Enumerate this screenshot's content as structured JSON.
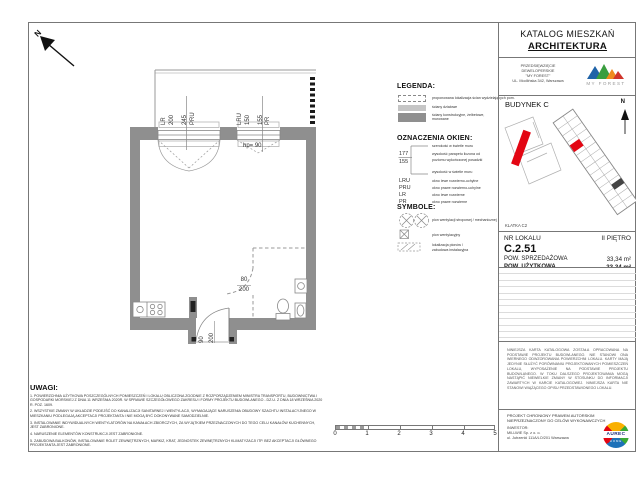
{
  "north_label": "N",
  "colors": {
    "accent_red": "#e30613",
    "wall_gray": "#8f8f8f"
  },
  "plan": {
    "window1": {
      "c1": "LR",
      "c2": "200",
      "c3": "245",
      "c4": "PRU"
    },
    "window2": {
      "c1": "LRU",
      "c2": "150",
      "c3": "155",
      "c4": "PR"
    },
    "hp_label": "hp= 90",
    "proposed_door_dim": {
      "top": "80",
      "bottom": "200"
    },
    "entry_door_dim": {
      "top": "90",
      "bottom": "200"
    }
  },
  "legend": {
    "title": "LEGENDA:",
    "items": [
      {
        "label": "proponowana lokalizacja ścian wydzielających pom."
      },
      {
        "label": "ściany działowe"
      },
      {
        "label": "ściany konstrukcyjne, żelbetowe,",
        "label2": "murowane"
      }
    ]
  },
  "windows_key": {
    "title": "OZNACZENIA OKIEN:",
    "width_label": "szerokość w świetle muru",
    "num_top": "177",
    "num_bottom": "155",
    "mid_label_1": "wysokość parapetu liczona od",
    "mid_label_2": "poziomu wykończonej posadzki",
    "height_label": "wysokość w świetle muru",
    "abbrevs": [
      {
        "abbr": "LRU",
        "label": "okno lewe rozwierno-uchylne"
      },
      {
        "abbr": "PRU",
        "label": "okno prawe rozwierno-uchylne"
      },
      {
        "abbr": "LR",
        "label": "okno lewe rozwierne"
      },
      {
        "abbr": "PR",
        "label": "okno prawe rozwierne"
      }
    ]
  },
  "symbols": {
    "title": "SYMBOLE:",
    "items": [
      {
        "label": "pion wentylacji stropowej / mechanicznej"
      },
      {
        "label": "pion wentylacyjny"
      },
      {
        "label": "lokalizacja pionów /",
        "label2": "zabudowa instalacyjna"
      }
    ]
  },
  "uwagi": {
    "title": "UWAGI:",
    "notes": [
      "1. POWIERZCHNIA UŻYTKOWA POSZCZEGÓLNYCH POMIESZCZEŃ I LOKALU OBLICZONA ZGODNIE Z ROZPORZĄDZENIEM MINISTRA TRANSPORTU, BUDOWNICTWA I GOSPODARKI MORSKIEJ Z DNIA 11 WRZEŚNIA 2020R. W SPRAWIE SZCZEGÓŁOWEGO ZAKRESU I FORMY PROJEKTU BUDOWLANEGO - DZ.U. Z DNIA 18 WRZEŚNIA 2020 R. POZ. 1609.",
      "2. WSZYSTKIE ZMIANY W UKŁADZIE PODEJŚĆ DO KANALIZACJI SANITARNEJ I WENTYLACJI, WYMAGAJĄCE NARUSZENIA OBUDOWY SZACHTU INSTALACYJNEGO W MIESZKANIU PODLEGAJĄ AKCEPTACJI PROJEKTANTA I NIE MOGĄ BYĆ DOKONYWANE SAMODZIELNIE.",
      "3. INSTALOWANIE INDYWIDUALNYCH WENTYLATORÓW NA KANAŁACH ZBIORCZYCH, ZA WYJĄTKIEM PRZEZNACZONYCH DO TEGO CELU KANAŁÓW KUCHENNYCH, JEST ZABRONIONE.",
      "4. NARUSZENIE ELEMENTÓW KONSTRUKCJI JEST ZABRONIONE.",
      "5. ZABUDOWA BALKONÓW, INSTALOWANIE ROLET ZEWNĘTRZNYCH, MARKIZ, KRAT, JEDNOSTEK ZEWNĘTRZNYCH KLIMATYZACJI ITP. BEZ AKCEPTACJI GŁÓWNEGO PROJEKTANTA JEST ZABRONIONE."
    ]
  },
  "scale": {
    "labels": [
      "0",
      "1",
      "2",
      "3",
      "4",
      "5"
    ]
  },
  "panel": {
    "catalog_title": "KATALOG MIESZKAŃ",
    "catalog_subtitle": "ARCHITEKTURA",
    "developer_lines": [
      "PRZEDSIĘWZIĘCIE",
      "DEWELOPERSKIE",
      "\"MY FOREST\"",
      "UL. Modlińska 342, Warszawa"
    ],
    "brand": "MY FOREST",
    "building_label": "BUDYNEK C",
    "building_north": "N",
    "klatka_label": "KLATKA C2",
    "unit": {
      "nr_label": "NR LOKALU",
      "floor": "II PIĘTRO",
      "number": "C.2.51",
      "rows": [
        {
          "label": "POW. SPRZEDAŻOWA",
          "value": "33,34 m²"
        },
        {
          "label": "POW. UŻYTKOWA",
          "value": "33,34 m²"
        }
      ],
      "empty_row_count": 12,
      "balkon_label": "BALKON",
      "balkon_value": "8,48 m²"
    },
    "disclaimer": "NINIEJSZA KARTA KATALOGOWA ZOSTAŁA OPRACOWANA NA PODSTAWIE PROJEKTU BUDOWLANEGO. NIE STANOWI ONA WIERNEGO ODWZOROWANIA POWIERZCHNI LOKALU. KARTY MAJĄ JEDYNIE SŁUŻYĆ PORÓWNANIU PROJEKTOWANYCH POMIESZCZEŃ LOKALU, WYPOSAŻENIE NA PODSTAWIE PROJEKTU BUDOWLANEGO. W TOKU DALSZEGO PROJEKTOWANIA MOGĄ NASTĄPIĆ NIEWIELKIE ZMIANY W STOSUNKU DO INFORMACJI ZAWARTYCH W KARCIE KATALOGOWEJ. NINIEJSZA KARTA NIE STANOWI WIĄŻĄCEGO OPISU PRZEDSTAWIONEGO LOKALU.",
    "copyright_1": "PROJEKT CHRONIONY PRAWEM AUTORSKIM",
    "copyright_2": "NIEPRZEZNACZONY DO CELÓW WYKONAWCZYCH",
    "investor_lines": [
      "INWESTOR:",
      "MILLWIE Sp. z o. o.",
      "ul. Jutrzenki 111A/LO/201 Warszawa"
    ],
    "aurec": {
      "name": "AUREC",
      "sub": "HOME"
    }
  }
}
